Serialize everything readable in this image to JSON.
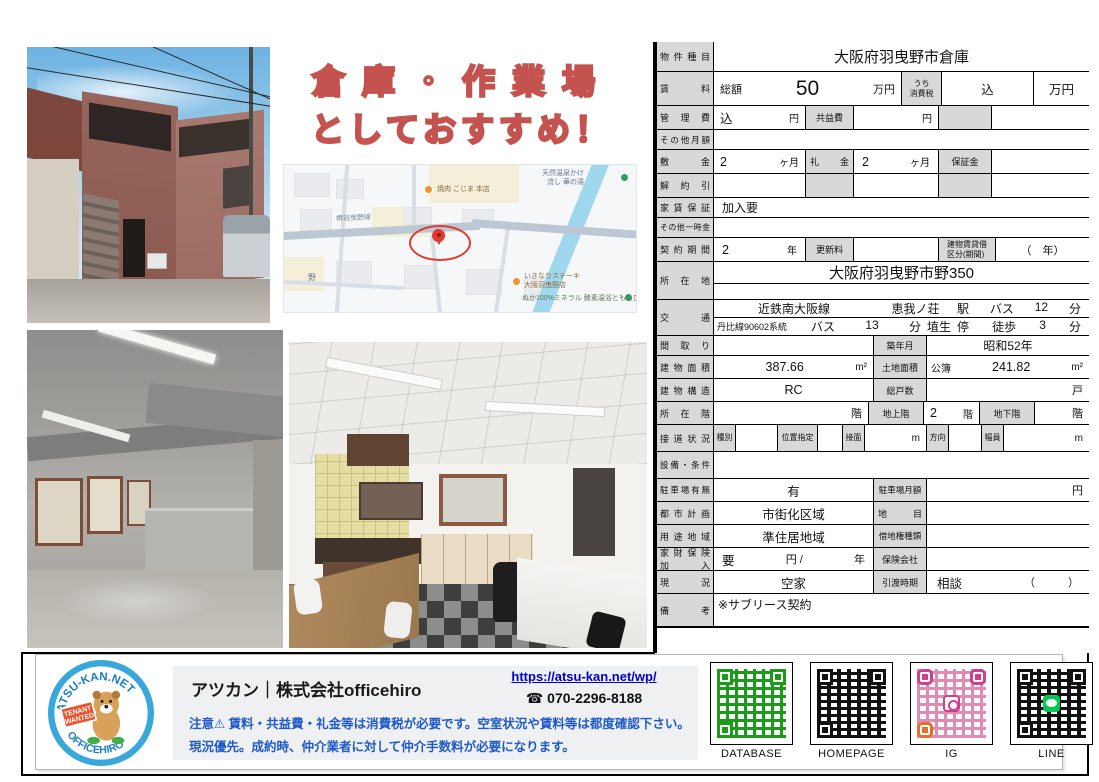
{
  "headline": {
    "line1": "倉庫・作業場",
    "line2": "としておすすめ！"
  },
  "map": {
    "poi_onsen_l1": "天然温泉かけ",
    "poi_onsen_l2": "流し 華の湯",
    "poi_yakiniku": "焼肉 こじま 本店",
    "road_name": "堺羽曳野線",
    "area_label": "野",
    "poi_steak_l1": "いきなりステーキ",
    "poi_steak_l2": "大阪羽曳野店",
    "poi_nuka_l1": "ぬか100%ミネラル",
    "poi_nuka_l2": "酵素温浴ともしび"
  },
  "table": {
    "type": {
      "label": "物件種目",
      "value": "大阪府羽曳野市倉庫"
    },
    "rent": {
      "label": "賃料",
      "total": "総額",
      "amount": "50",
      "unit": "万円",
      "tax_l1": "うち",
      "tax_l2": "消費税",
      "tax_value": "込",
      "tax_unit": "万円"
    },
    "kanri": {
      "label": "管理費",
      "value": "込",
      "yen": "円",
      "kyoueki": "共益費",
      "kyoueki_yen": "円"
    },
    "other_monthly": {
      "label": "その他月額"
    },
    "shiki": {
      "label": "敷金",
      "v1": "2",
      "u1": "ヶ月",
      "rei": "礼金",
      "v2": "2",
      "u2": "ヶ月",
      "hosho": "保証金"
    },
    "kaiyaku": {
      "label": "解約引"
    },
    "yachin": {
      "label": "家賃保証",
      "value": "加入要"
    },
    "ichiji": {
      "label": "その他一時金"
    },
    "keiyaku": {
      "label": "契約期間",
      "v": "2",
      "u": "年",
      "koshin": "更新料",
      "kubun_l1": "建物賃貸借",
      "kubun_l2": "区分(期間)",
      "kubun_value": "（　年）"
    },
    "address": {
      "label": "所在地",
      "value": "大阪府羽曳野市野350"
    },
    "kotsu": {
      "label": "交通",
      "l1a": "近鉄南大阪線",
      "l1b": "恵我ノ荘",
      "l1c": "駅",
      "l1d": "バス",
      "l1e": "12",
      "l1f": "分",
      "l2a": "丹比線90602系統",
      "l2b": "バス",
      "l2c": "13",
      "l2d": "分",
      "l2e": "埴生",
      "l2f": "停",
      "l2g": "徒歩",
      "l2h": "3",
      "l2i": "分"
    },
    "madori": {
      "label": "間取り",
      "chiku": "築年月",
      "chiku_value": "昭和52年"
    },
    "menseki": {
      "label": "建物面積",
      "value": "387.66",
      "unit": "m²",
      "tochi": "土地面積",
      "kobo": "公簿",
      "tochi_value": "241.82",
      "tochi_unit": "m²"
    },
    "kozo": {
      "label": "建物構造",
      "value": "RC",
      "soko": "総戸数",
      "soko_unit": "戸"
    },
    "kai": {
      "label": "所在階",
      "u0": "階",
      "chijo": "地上階",
      "v": "2",
      "u1": "階",
      "chika": "地下階",
      "u2": "階"
    },
    "setsudo": {
      "label": "接道状況",
      "shubetsu": "種別",
      "ichi": "位置指定",
      "setsumen": "接面",
      "m1": "m",
      "hoko": "方向",
      "fukuin": "幅員",
      "m2": "m"
    },
    "setsubi": {
      "label": "設備・条件"
    },
    "parking": {
      "label": "駐車場有無",
      "value": "有",
      "monthly": "駐車場月額",
      "yen": "円"
    },
    "toshi": {
      "label": "都市計画",
      "value": "市街化区域",
      "chimoku": "地目"
    },
    "yoto": {
      "label": "用途地域",
      "value": "準住居地域",
      "shakuchi": "借地権種類"
    },
    "kazai": {
      "l1": "家財保険",
      "l2": "加入",
      "value": "要",
      "yen": "円 /",
      "nen": "年",
      "hoken": "保険会社"
    },
    "genkyo": {
      "label": "現況",
      "value": "空家",
      "hikiwatashi": "引渡時期",
      "v": "相談",
      "paren": "（　　　）"
    },
    "biko": {
      "label": "備考",
      "value": "※サブリース契約"
    }
  },
  "footer": {
    "company": "アツカン｜株式会社officehiro",
    "url": "https://atsu-kan.net/wp/",
    "phone_icon": "☎",
    "phone": "070-2296-8188",
    "note1": "注意⚠ 賃料・共益費・礼金等は消費税が必要です。空室状況や賃料等は都度確認下さい。",
    "note2": "現況優先。成約時、仲介業者に対して仲介手数料が必要になります。",
    "logo": {
      "top": "ATSU-KAN.NET",
      "bottom": "OFFICEHIRO",
      "sign_l1": "TENANT",
      "sign_l2": "WANTED"
    },
    "qr_labels": [
      "DATABASE",
      "HOMEPAGE",
      "IG",
      "LINE"
    ]
  },
  "colors": {
    "accent_red": "#c4524e",
    "qr_green": "#1a9c1a",
    "qr_black": "#111111",
    "ig_pink": "#cf3f8e",
    "line_green": "#06c755",
    "link_blue": "#0000cc",
    "note_blue": "#1f5ac8"
  }
}
